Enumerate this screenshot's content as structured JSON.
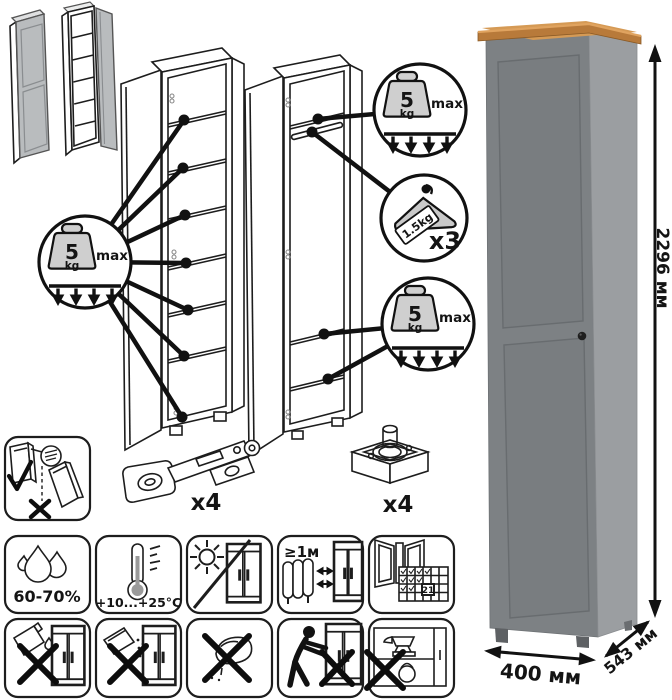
{
  "product": {
    "name": "tall-wardrobe",
    "colors": {
      "front": "#7d8184",
      "side": "#9b9ea1",
      "top_wood": "#b87a3a",
      "top_wood_light": "#d59a55",
      "knob": "#1f1f1f"
    }
  },
  "dimensions": {
    "height": "2296 мм",
    "width": "400 мм",
    "depth": "543 мм"
  },
  "load_limits": {
    "shelf_badge": {
      "value": "5",
      "unit": "kg",
      "qualifier": "max"
    },
    "hanger_badge": {
      "per_item": "1.5kg",
      "count": "x3"
    }
  },
  "hardware": {
    "hinge": {
      "count": "x4"
    },
    "foot": {
      "count": "x4"
    }
  },
  "environment": {
    "humidity": "60-70%",
    "temperature": "+10...+25°C",
    "min_heat_distance": "≥1м",
    "calendar_day": "21"
  },
  "icons": {
    "row1": [
      "anti-tip-wall-mount",
      "hinge",
      "adjustable-foot"
    ],
    "row2": [
      "humidity",
      "temperature",
      "no-direct-sunlight",
      "keep-distance-from-heat",
      "ventilate-room"
    ],
    "row3": [
      "no-solvents",
      "no-abrasive-powder",
      "no-wet-sponge",
      "no-dragging",
      "no-heavy-objects"
    ]
  }
}
